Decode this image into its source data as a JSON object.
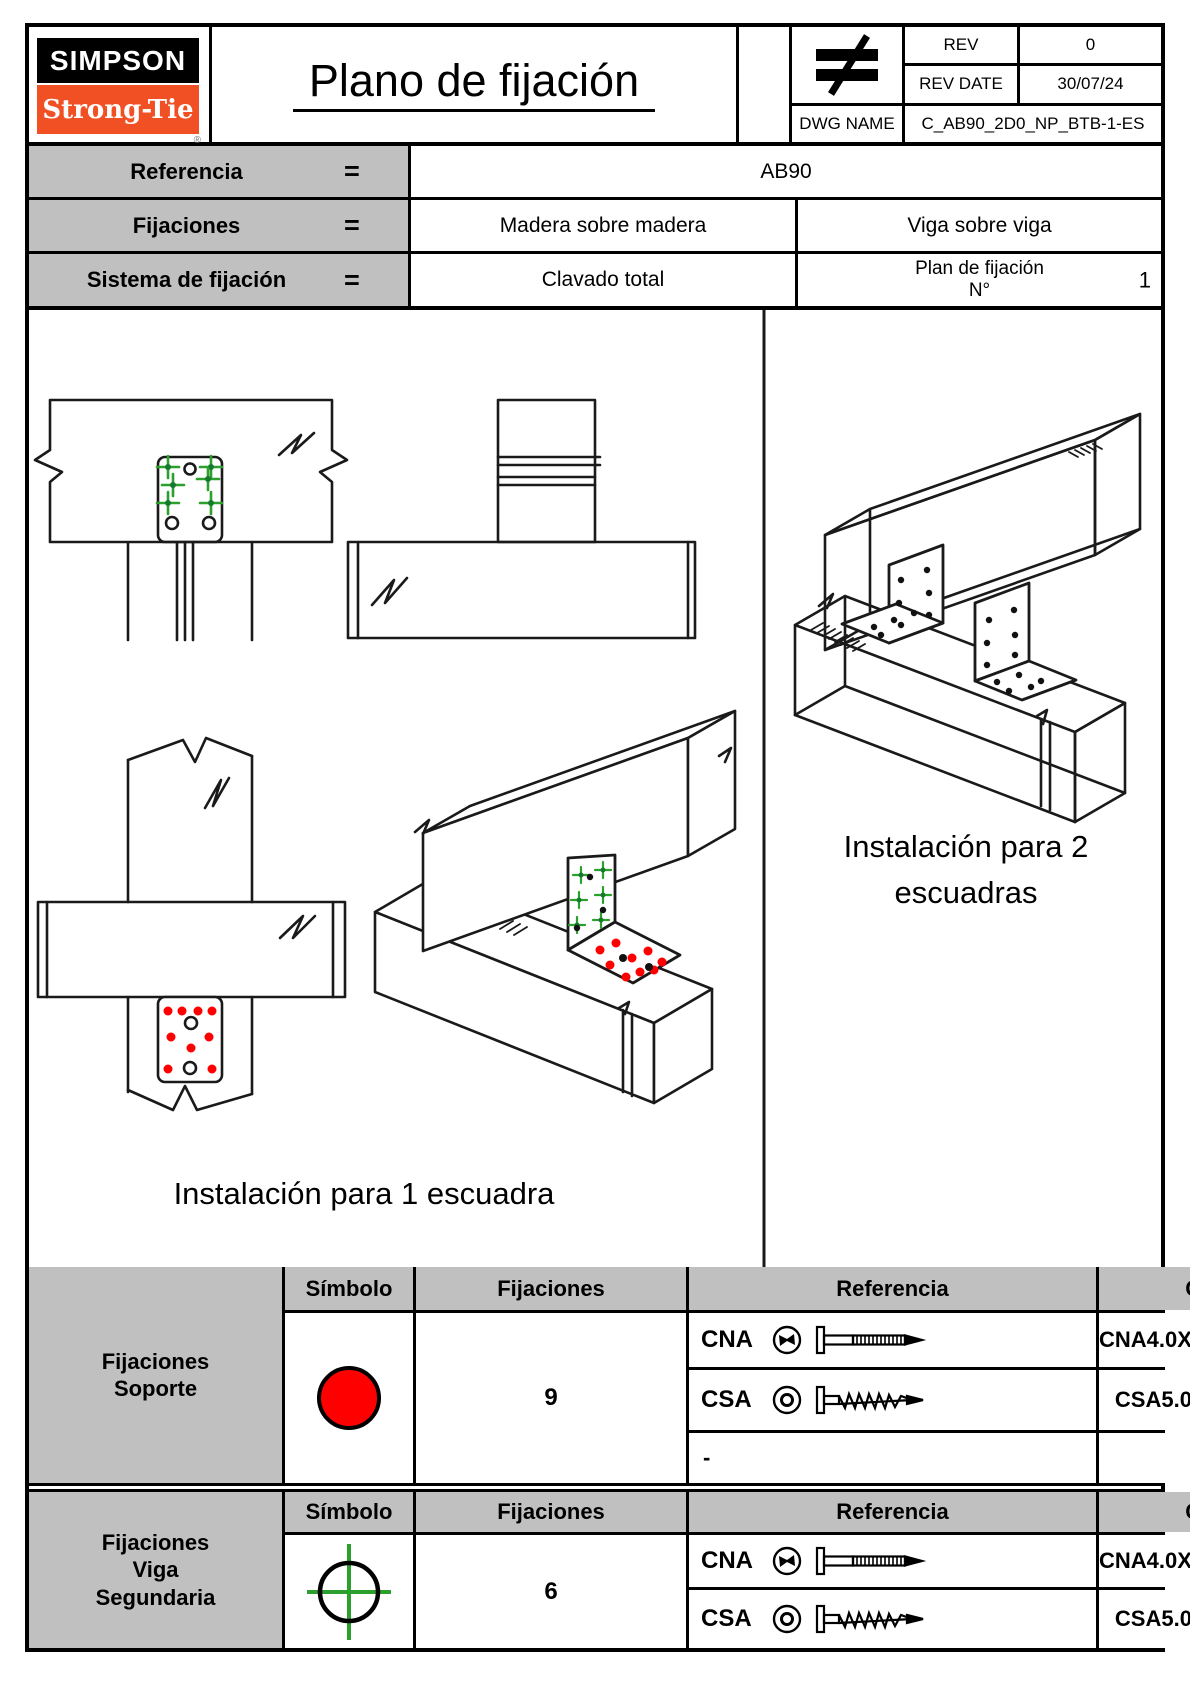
{
  "colors": {
    "accent_orange": "#f05023",
    "symbol_red": "#ff0000",
    "marker_green": "#2ca02c",
    "header_gray": "#c0c0c0",
    "line_black": "#000000"
  },
  "logo": {
    "top": "SIMPSON",
    "bottom": "Strong-Tie",
    "registered": "®"
  },
  "title": "Plano de fijación",
  "title_block": {
    "projection_symbol_icon": "not-equal-projection-icon",
    "rev_label": "REV",
    "rev_value": "0",
    "rev_date_label": "REV DATE",
    "rev_date_value": "30/07/24",
    "dwg_label": "DWG NAME",
    "dwg_value": "C_AB90_2D0_NP_BTB-1-ES"
  },
  "info_table": {
    "equals": "=",
    "row1": {
      "label": "Referencia",
      "value": "AB90"
    },
    "row2": {
      "label": "Fijaciones",
      "value_left": "Madera sobre madera",
      "value_right": "Viga sobre viga"
    },
    "row3": {
      "label": "Sistema de fijación",
      "value_left": "Clavado total",
      "plan_label": "Plan de fijación",
      "plan_no": "N°",
      "plan_value": "1"
    }
  },
  "drawings": {
    "caption_single": "Instalación para 1 escuadra",
    "caption_double_line1": "Instalación para 2",
    "caption_double_line2": "escuadras",
    "support_marker_icon": "red-dot-marker",
    "secondary_marker_icon": "green-cross-marker"
  },
  "fastener_tables": {
    "headers": {
      "symbol": "Símbolo",
      "fixings": "Fijaciones",
      "reference": "Referencia",
      "qty": "Ctd"
    },
    "support": {
      "group_label": "Fijaciones\nSoporte",
      "symbol_icon": "red-circle-icon",
      "rows": [
        {
          "code": "CNA",
          "head_icon": "nail-head-icon",
          "fastener_icon": "ring-nail-icon",
          "reference": "CNA4.0X35/40/50/60"
        },
        {
          "code": "CSA",
          "head_icon": "screw-head-icon",
          "fastener_icon": "wood-screw-icon",
          "reference": "CSA5.0X35/40/50"
        },
        {
          "code": "-",
          "reference": "-"
        }
      ],
      "qty": "9"
    },
    "secondary": {
      "group_label": "Fijaciones\nViga\nSegundaria",
      "symbol_icon": "green-crosshair-icon",
      "rows": [
        {
          "code": "CNA",
          "head_icon": "nail-head-icon",
          "fastener_icon": "ring-nail-icon",
          "reference": "CNA4.0X35/40/50/60"
        },
        {
          "code": "CSA",
          "head_icon": "screw-head-icon",
          "fastener_icon": "wood-screw-icon",
          "reference": "CSA5.0X35/40/50"
        }
      ],
      "qty": "6"
    }
  }
}
